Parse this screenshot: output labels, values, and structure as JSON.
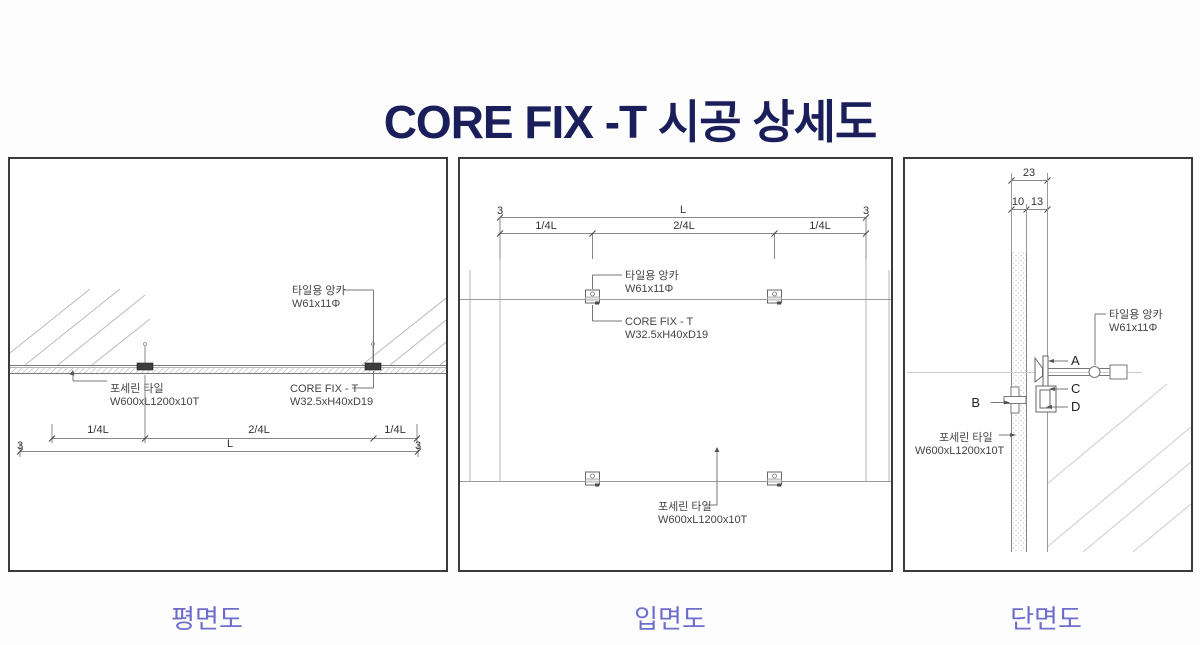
{
  "title": "CORE FIX -T 시공 상세도",
  "colors": {
    "title": "#1a1e5a",
    "caption": "#6d6ec9"
  },
  "panels": {
    "plan": {
      "caption": "평면도",
      "dim_quarter": "1/4L",
      "dim_half": "2/4L",
      "dim_total": "L",
      "dim_joint": "3",
      "tile_anchor": [
        "타일용 앙카",
        "W61x11Φ"
      ],
      "porcelain_tile": [
        "포세린 타일",
        "W600xL1200x10T"
      ],
      "core_fix": [
        "CORE FIX - T",
        "W32.5xH40xD19"
      ]
    },
    "elevation": {
      "caption": "입면도",
      "dim_quarter": "1/4L",
      "dim_half": "2/4L",
      "dim_total": "L",
      "dim_joint": "3",
      "tile_anchor": [
        "타일용 앙카",
        "W61x11Φ"
      ],
      "porcelain_tile": [
        "포세린 타일",
        "W600xL1200x10T"
      ],
      "core_fix": [
        "CORE FIX - T",
        "W32.5xH40xD19"
      ]
    },
    "section": {
      "caption": "단면도",
      "dim_total": "23",
      "dim_tile": "10",
      "dim_offset": "13",
      "tile_anchor": [
        "타일용 앙카",
        "W61x11Φ"
      ],
      "porcelain_tile": [
        "포세린 타일",
        "W600xL1200x10T"
      ],
      "markers": [
        "A",
        "B",
        "C",
        "D"
      ]
    }
  }
}
